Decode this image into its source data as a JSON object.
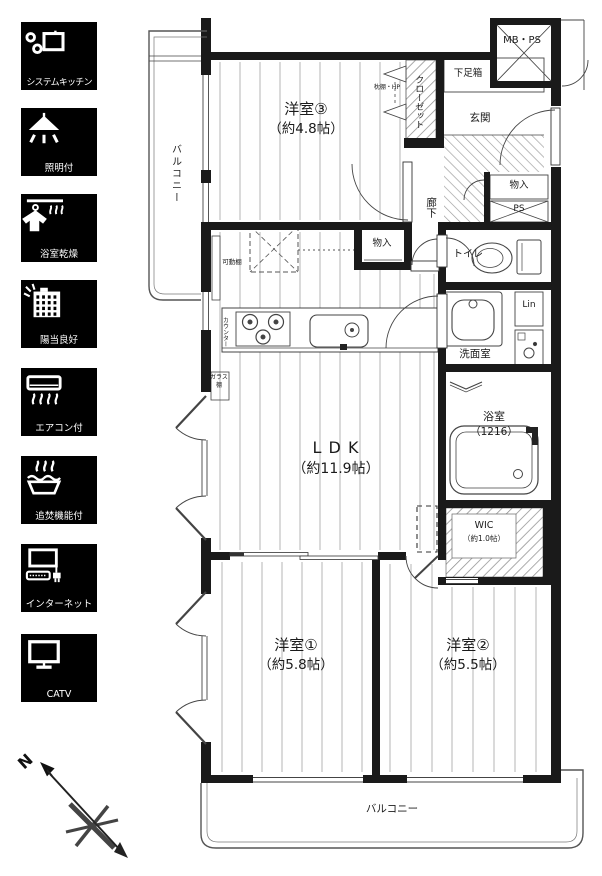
{
  "sidebar": {
    "items": [
      {
        "label": "システムキッチン",
        "icon": "system-kitchen-icon"
      },
      {
        "label": "照明付",
        "icon": "lighting-icon"
      },
      {
        "label": "浴室乾燥",
        "icon": "bathroom-dryer-icon"
      },
      {
        "label": "陽当良好",
        "icon": "sunlight-icon"
      },
      {
        "label": "エアコン付",
        "icon": "air-conditioner-icon"
      },
      {
        "label": "追焚機能付",
        "icon": "reheat-function-icon"
      },
      {
        "label": "インターネット",
        "icon": "internet-icon"
      },
      {
        "label": "CATV",
        "icon": "catv-icon"
      }
    ]
  },
  "compass": {
    "north_label": "N"
  },
  "plan": {
    "rooms": {
      "bedroom3": {
        "name": "洋室③",
        "size": "（約4.8帖）"
      },
      "ldk": {
        "name": "L D K",
        "size": "（約11.9帖）"
      },
      "bedroom1": {
        "name": "洋室①",
        "size": "（約5.8帖）"
      },
      "bedroom2": {
        "name": "洋室②",
        "size": "（約5.5帖）"
      },
      "bath": {
        "name": "浴室",
        "size": "（1216）"
      },
      "wic": {
        "name": "WIC",
        "size": "（約1.0帖）"
      },
      "washroom": {
        "name": "洗面室"
      },
      "toilet": {
        "name": "トイレ"
      },
      "entrance": {
        "name": "玄関"
      },
      "hallway": {
        "name": "廊下"
      },
      "balcony_left": {
        "name": "バルコニー"
      },
      "balcony_bottom": {
        "name": "バルコニー"
      }
    },
    "labels": {
      "closet": "クローゼット",
      "closet_note": "枕棚・HP",
      "shoe_box": "下足箱",
      "meter_box": "MB・PS",
      "storage_hall": "物入",
      "pipe_space": "PS",
      "storage_kitchen": "物入",
      "linen": "Lin",
      "movable_shelf": "可動棚",
      "counter": "カウンター",
      "glass_shelf": "ガラス棚"
    }
  },
  "colors": {
    "wall": "#1a1a1a",
    "floor_line": "#b4b4b4",
    "hatch": "#8f8f8f",
    "tile_bg": "#000000",
    "tile_text": "#ffffff"
  }
}
